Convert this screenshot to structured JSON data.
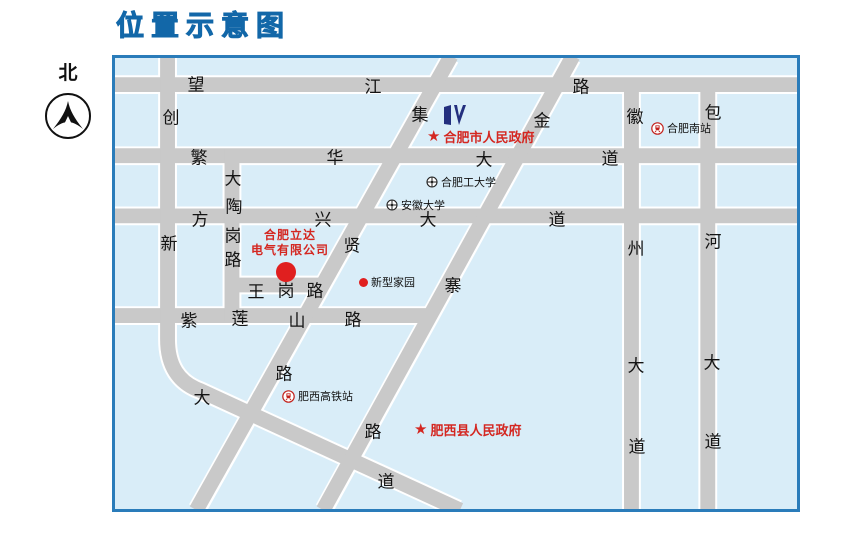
{
  "page": {
    "title": "位置示意图",
    "north_label": "北"
  },
  "colors": {
    "title_blue": "#1577bb",
    "map_border": "#2a7cba",
    "map_bg": "#d9edf8",
    "road_gray": "#c9c9c9",
    "poi_red": "#d42721",
    "logo_navy": "#232f7e",
    "label_black": "#141414"
  },
  "icons": {
    "star": "★"
  },
  "map": {
    "roads": [
      {
        "name": "望江路",
        "chars": [
          {
            "t": "望",
            "x": 81,
            "y": 25
          },
          {
            "t": "江",
            "x": 258,
            "y": 27
          },
          {
            "t": "路",
            "x": 466,
            "y": 27
          }
        ]
      },
      {
        "name": "繁华大道",
        "chars": [
          {
            "t": "繁",
            "x": 84,
            "y": 98
          },
          {
            "t": "华",
            "x": 220,
            "y": 98
          },
          {
            "t": "大",
            "x": 369,
            "y": 100
          },
          {
            "t": "道",
            "x": 495,
            "y": 99
          }
        ]
      },
      {
        "name": "方兴大道",
        "chars": [
          {
            "t": "方",
            "x": 85,
            "y": 160
          },
          {
            "t": "兴",
            "x": 208,
            "y": 160
          },
          {
            "t": "大",
            "x": 313,
            "y": 160
          },
          {
            "t": "道",
            "x": 442,
            "y": 160
          }
        ]
      },
      {
        "name": "王岗路",
        "chars": [
          {
            "t": "王",
            "x": 141,
            "y": 232
          },
          {
            "t": "岗",
            "x": 171,
            "y": 231
          },
          {
            "t": "路",
            "x": 200,
            "y": 231
          }
        ]
      },
      {
        "name": "紫莲山路",
        "chars": [
          {
            "t": "紫",
            "x": 74,
            "y": 261
          },
          {
            "t": "莲",
            "x": 125,
            "y": 259
          },
          {
            "t": "山",
            "x": 182,
            "y": 261
          },
          {
            "t": "路",
            "x": 238,
            "y": 260
          }
        ]
      },
      {
        "name": "创新大道",
        "chars": [
          {
            "t": "创",
            "x": 56,
            "y": 58
          },
          {
            "t": "新",
            "x": 54,
            "y": 184
          },
          {
            "t": "大",
            "x": 87,
            "y": 338
          },
          {
            "t": "道",
            "x": 271,
            "y": 422
          }
        ]
      },
      {
        "name": "大陶岗路",
        "chars": [
          {
            "t": "大",
            "x": 118,
            "y": 119
          },
          {
            "t": "陶",
            "x": 119,
            "y": 147
          },
          {
            "t": "岗",
            "x": 118,
            "y": 176
          },
          {
            "t": "路",
            "x": 118,
            "y": 200
          }
        ]
      },
      {
        "name": "徽州大道",
        "chars": [
          {
            "t": "徽",
            "x": 520,
            "y": 57
          },
          {
            "t": "州",
            "x": 521,
            "y": 189
          },
          {
            "t": "大",
            "x": 521,
            "y": 306
          },
          {
            "t": "道",
            "x": 522,
            "y": 387
          }
        ]
      },
      {
        "name": "包河大道",
        "chars": [
          {
            "t": "包",
            "x": 598,
            "y": 53
          },
          {
            "t": "河",
            "x": 598,
            "y": 182
          },
          {
            "t": "大",
            "x": 597,
            "y": 303
          },
          {
            "t": "道",
            "x": 598,
            "y": 382
          }
        ]
      },
      {
        "name": "集贤路",
        "chars": [
          {
            "t": "集",
            "x": 305,
            "y": 55
          },
          {
            "t": "贤",
            "x": 237,
            "y": 186
          },
          {
            "t": "路",
            "x": 169,
            "y": 314
          }
        ]
      },
      {
        "name": "金寨路",
        "chars": [
          {
            "t": "金",
            "x": 427,
            "y": 61
          },
          {
            "t": "寨",
            "x": 338,
            "y": 226
          },
          {
            "t": "路",
            "x": 258,
            "y": 372
          }
        ]
      }
    ],
    "pois": {
      "city_gov": {
        "label": "合肥市人民政府"
      },
      "hfut": {
        "label": "合肥工大学"
      },
      "anhui_univ": {
        "label": "安徽大学"
      },
      "company": {
        "line1": "合肥立达",
        "line2": "电气有限公司"
      },
      "xinxing": {
        "label": "新型家园"
      },
      "feixi_station": {
        "label": "肥西高铁站"
      },
      "feixi_gov": {
        "label": "肥西县人民政府"
      },
      "hefei_south": {
        "label": "合肥南站"
      }
    }
  }
}
